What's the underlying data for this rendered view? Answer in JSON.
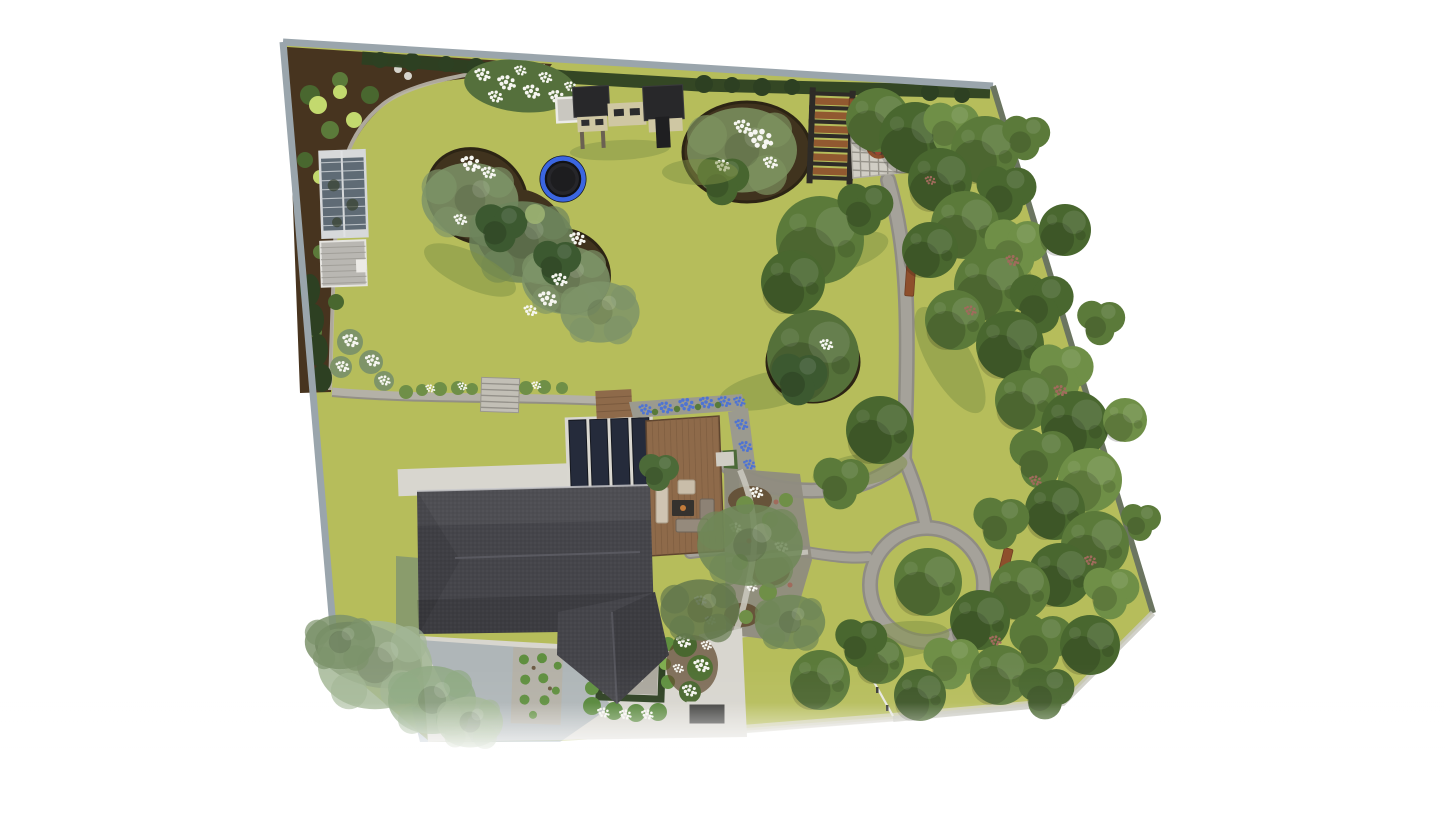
{
  "scene": {
    "kind": "3d-garden-landscape-design-render",
    "view": "aerial-top-down",
    "canvas": {
      "width": 1445,
      "height": 813
    },
    "background": "#ffffff"
  },
  "palette": {
    "lawn": "#b6bd5b",
    "lawnShadow": "#7f9044",
    "mulch": "#47341f",
    "mulchLight": "#5d4529",
    "soil": "#40331e",
    "soilEdge": "#2c2414",
    "hedge": "#2d4022",
    "leaf1": "#49672f",
    "leaf2": "#5b7a3a",
    "leaf3": "#6f8f47",
    "leafLight": "#9fb573",
    "sage": "#7e9468",
    "sageLight": "#a3b795",
    "chartreuse": "#c3d96e",
    "flowerWhite": "#f6f6f1",
    "flowerBlue": "#4f74d2",
    "flowerPink": "#a06b5c",
    "path": "#a5a29a",
    "pathEdge": "#8f8c84",
    "pathLight": "#c9c6bd",
    "gravel": "#b4b1a7",
    "concrete": "#d8d6cf",
    "paver": "#d0cdc4",
    "paverLine": "#97948b",
    "roof": "#45454a",
    "roofDark": "#3e3e43",
    "roofLight": "#62626a",
    "panel": "#252b3b",
    "deck": "#8e6a4a",
    "deckLine": "#7a5a3e",
    "corten": "#8e4f2c",
    "trampolineRing": "#3b66e0",
    "trampolineMat": "#1d1d1f",
    "water": "#257a80",
    "fence": "#9aa5ac",
    "fenceDark": "#6b7560",
    "wallLight": "#c9c9c1",
    "glass": "#5f6b75",
    "glassFrame": "#c9ced2",
    "shedRoof": "#b9b7b2",
    "houseShadow": "#4e6e86",
    "playhouseRoof": "#28282a",
    "playhouseWall": "#cfc7a3"
  },
  "features": [
    "property-boundary-fence",
    "lawn",
    "perimeter-hedge",
    "mulch-border-bed",
    "greenhouse",
    "garden-shed",
    "white-flower-bed",
    "playhouse-set",
    "sandbox",
    "trampoline",
    "kidney-planting-bed",
    "ornamental-tree-bed",
    "pergola",
    "paver-patio",
    "corten-planter",
    "corten-raised-bed",
    "garden-bench",
    "stone-garden-path",
    "path-loop",
    "house-roof",
    "roof-panels",
    "concrete-terrace",
    "wooden-deck",
    "outdoor-lounge-set",
    "fire-table",
    "blue-flower-border",
    "gravel-garden",
    "retaining-wall-steps",
    "boxwood-parterre",
    "square-fountain",
    "clipped-shrub-row",
    "front-gravel-bed",
    "cellar-hatch",
    "driveway",
    "low-rail-fence",
    "tree-group",
    "sage-tree",
    "tree-shadow"
  ]
}
